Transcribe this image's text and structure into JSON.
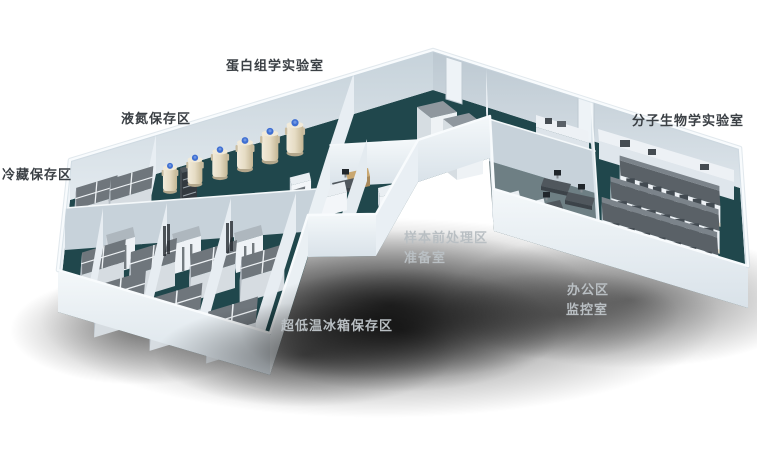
{
  "colors": {
    "background": "#ffffff",
    "label_text": "#3b4045",
    "label_text_light": "#b9bfc3",
    "floor_teal": "#20474c",
    "floor_office": "#6e7f84",
    "wall_bright": "#f2f6f9",
    "wall_shaded": "#c7d2da",
    "wall_face": "#dde6ec",
    "equipment_top": "#6f767c",
    "tank_body": "#e8dfc9",
    "tank_cap": "#3f6fd2",
    "desk_tan": "#c9a770",
    "bench_top": "#596167"
  },
  "labels": [
    {
      "id": "proteomics-lab",
      "text": "蛋白组学实验室"
    },
    {
      "id": "liquid-nitrogen-storage",
      "text": "液氮保存区"
    },
    {
      "id": "cold-storage",
      "text": "冷藏保存区"
    },
    {
      "id": "molecular-biology-lab",
      "text": "分子生物学实验室"
    },
    {
      "id": "sample-pretreatment-area",
      "text": "样本前处理区"
    },
    {
      "id": "preparation-room",
      "text": "准备室"
    },
    {
      "id": "office-area",
      "text": "办公区"
    },
    {
      "id": "monitoring-room",
      "text": "监控室"
    },
    {
      "id": "ult-freezer-storage",
      "text": "超低温冰箱保存区"
    }
  ]
}
